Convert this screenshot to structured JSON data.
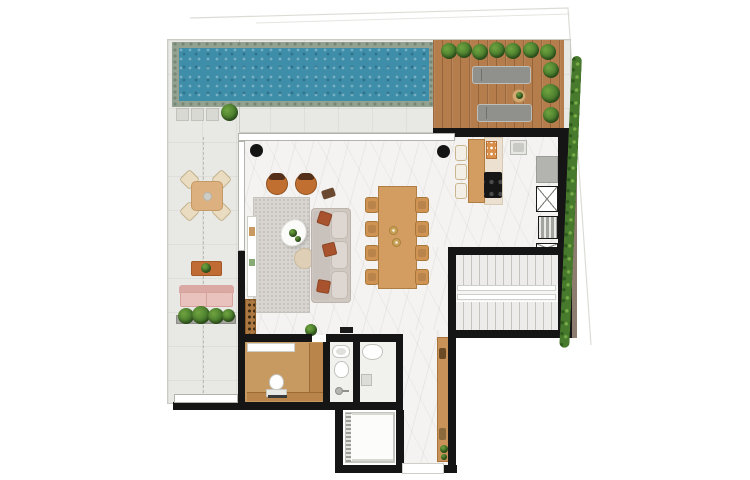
{
  "meta": {
    "title": "Penthouse floor plan - top view render",
    "kind": "architectural-floor-plan",
    "visible_text": []
  },
  "colors": {
    "wall": "#151515",
    "tile": "#e8e8e4",
    "marble": "#f4f3f1",
    "poolWater": "#3f8ea9",
    "poolCoping": "#93a291",
    "deckWood": "#b57d4c",
    "bushGreen": "#477a2c",
    "rug": "#d8d5d1",
    "sofaCream": "#cfc8c1",
    "pillowRust": "#a8532e",
    "chairOrange": "#c06f31",
    "diningWood": "#d39c60",
    "pinkSofa": "#e9c2bd",
    "terracottaTable": "#c06b33",
    "powderWood": "#c79a62",
    "sideboardWood": "#c89258",
    "counterGray": "#b3b3af",
    "cooktopBlack": "#161616",
    "glassFrame": "#b3b3ae",
    "stairTread": "#c6c3bf",
    "elevatorFrame": "#c6c6c0",
    "taupe": "#8d7d70"
  },
  "rooms": [
    {
      "name": "pool",
      "floor": "water"
    },
    {
      "name": "sun-deck",
      "floor": "wood"
    },
    {
      "name": "terrace",
      "floor": "tile"
    },
    {
      "name": "living-room",
      "floor": "marble"
    },
    {
      "name": "dining-area",
      "floor": "marble"
    },
    {
      "name": "kitchen",
      "floor": "marble"
    },
    {
      "name": "staircase",
      "floor": "stone"
    },
    {
      "name": "powder-room",
      "floor": "wood"
    },
    {
      "name": "bathroom",
      "floor": "tile"
    },
    {
      "name": "wc",
      "floor": "tile"
    },
    {
      "name": "corridor",
      "floor": "marble"
    },
    {
      "name": "elevator",
      "floor": "cab"
    }
  ],
  "furniture": [
    "sun-lounger x2",
    "deck-side-table",
    "garden-bushes",
    "perimeter-hedge",
    "outdoor-dining-table with 4 chairs",
    "outdoor-coffee-table",
    "outdoor-sofa",
    "planter-box",
    "area-rug",
    "round-armchair x2",
    "organic-coffee-table",
    "pouf",
    "sofa with 3 rust pillows",
    "console-shelf",
    "wine-rack",
    "dining-table with 8 chairs",
    "pendant-light x2",
    "kitchen-island",
    "bar-stool x3",
    "cooktop",
    "kitchen-sink",
    "refrigerator",
    "service-shaft",
    "ac-grille",
    "toilet x3",
    "vanity-counter",
    "washbasin",
    "shower-head",
    "hallway-sideboard",
    "elevator-car"
  ]
}
